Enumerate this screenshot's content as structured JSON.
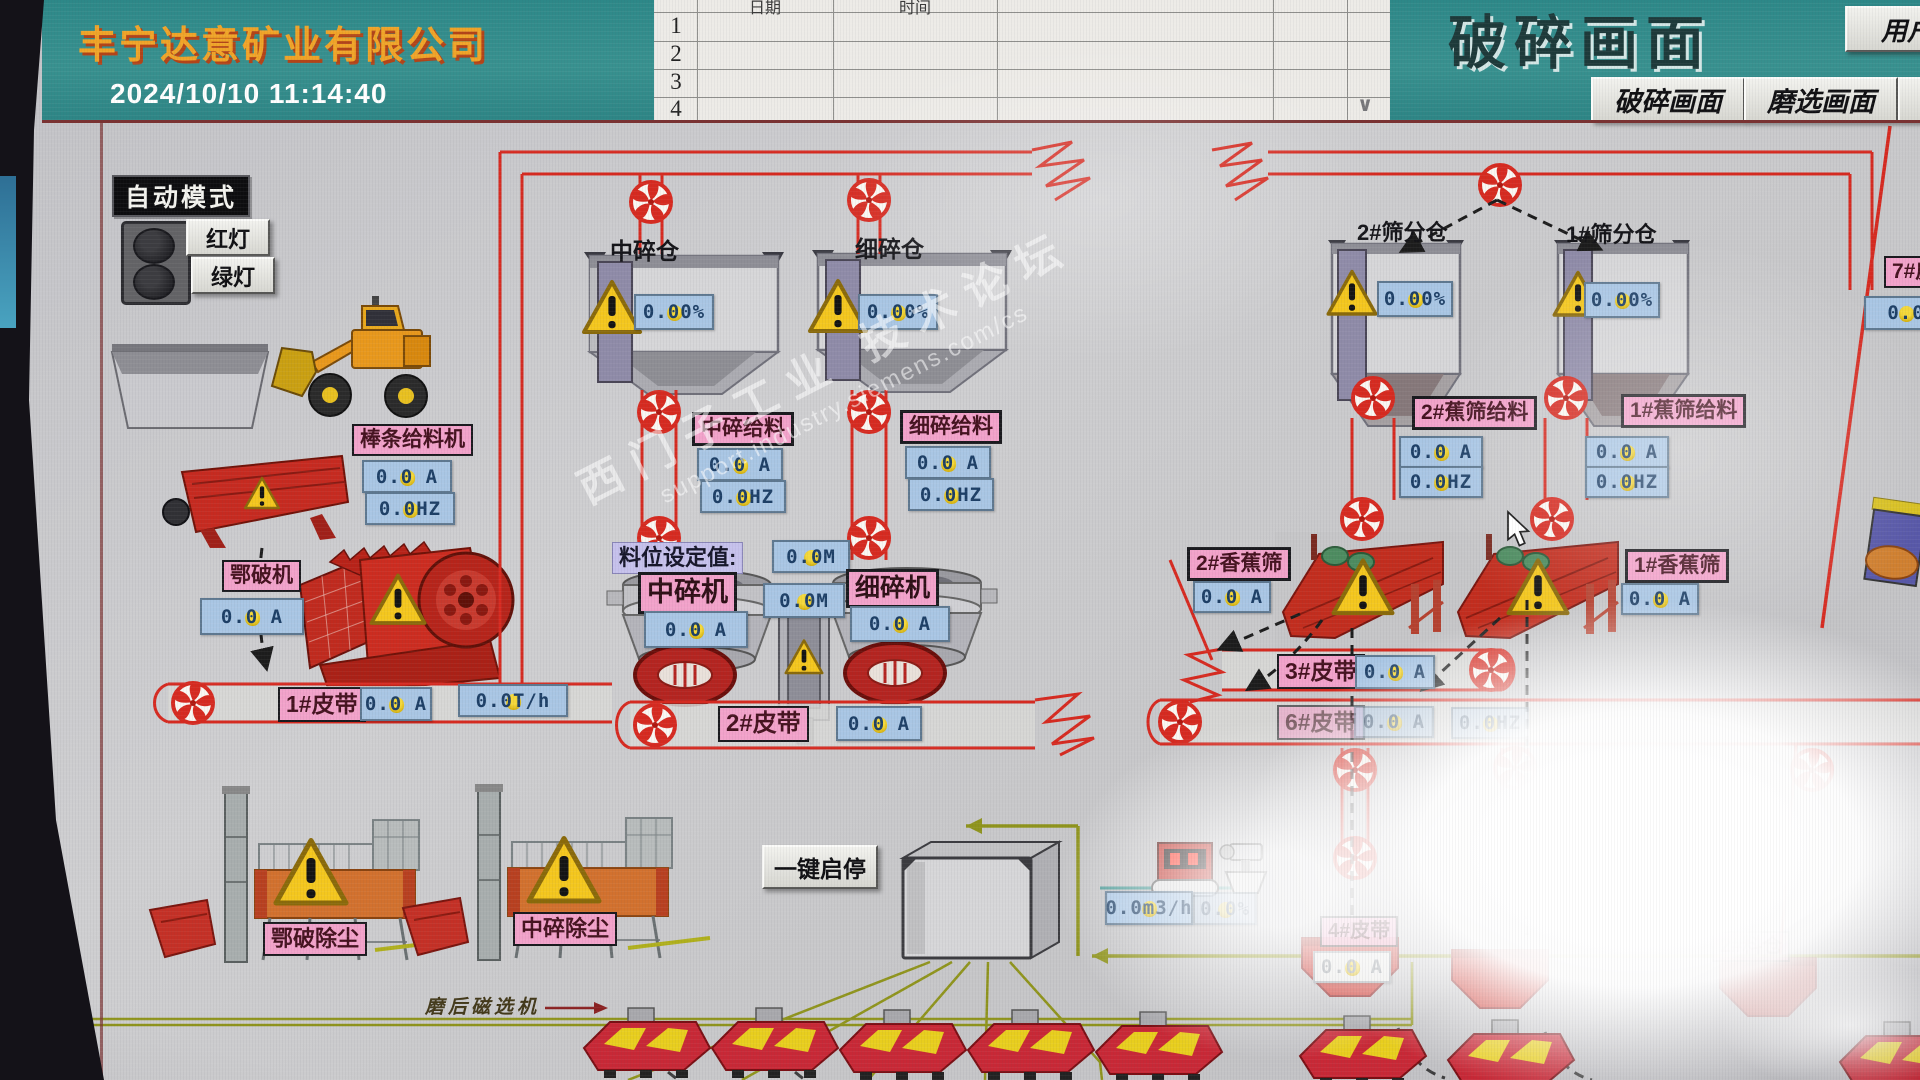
{
  "header": {
    "company_name": "丰宁达意矿业有限公司",
    "datetime": "2024/10/10 11:14:40",
    "screen_title": "破碎画面",
    "user_button": "用户",
    "tab_crushing": "破碎画面",
    "tab_grinding": "磨选画面",
    "log_table": {
      "col_date": "日期",
      "col_time": "时间",
      "row_numbers": [
        "1",
        "2",
        "3",
        "4"
      ],
      "scroll_hint": "∨"
    }
  },
  "status_panel": {
    "mode_label": "自动模式",
    "red_light_label": "红灯",
    "green_light_label": "绿灯"
  },
  "equipment": {
    "bar_feeder": {
      "label": "棒条给料机",
      "current": "0.0 A",
      "freq": "0.0HZ"
    },
    "jaw_crusher": {
      "label": "鄂破机",
      "current": "0.0 A"
    },
    "belt1": {
      "label": "1#皮带",
      "current": "0.0 A",
      "throughput": "0.0T/h"
    },
    "mid_bin": {
      "label": "中碎仓",
      "level_pct": "0.00%"
    },
    "fine_bin": {
      "label": "细碎仓",
      "level_pct": "0.00%"
    },
    "mid_feeder": {
      "label": "中碎给料",
      "current": "0.0 A",
      "freq": "0.0HZ"
    },
    "fine_feeder": {
      "label": "细碎给料",
      "current": "0.0 A",
      "freq": "0.0HZ"
    },
    "level_setpoint": {
      "label": "料位设定值:",
      "setpoint": "0.0M",
      "measured": "0.0M"
    },
    "mid_crusher": {
      "label": "中碎机",
      "current": "0.0 A"
    },
    "fine_crusher": {
      "label": "细碎机",
      "current": "0.0 A"
    },
    "belt2": {
      "label": "2#皮带",
      "current": "0.0 A"
    },
    "screen_bin2": {
      "label": "2#筛分仓",
      "level_pct": "0.00%"
    },
    "screen_bin1": {
      "label": "1#筛分仓",
      "level_pct": "0.00%"
    },
    "banana_feeder2": {
      "label": "2#蕉筛给料",
      "current": "0.0 A",
      "freq": "0.0HZ"
    },
    "banana_feeder1": {
      "label": "1#蕉筛给料",
      "current": "0.0 A",
      "freq": "0.0HZ"
    },
    "banana_screen2": {
      "label": "2#香蕉筛",
      "current": "0.0 A"
    },
    "banana_screen1": {
      "label": "1#香蕉筛",
      "current": "0.0 A"
    },
    "belt3": {
      "label": "3#皮带",
      "current": "0.0 A"
    },
    "belt6": {
      "label": "6#皮带",
      "current": "0.0 A",
      "freq": "0.0HZ"
    },
    "belt7": {
      "label": "7#皮带",
      "current": "0.0"
    },
    "belt4": {
      "label": "4#皮带",
      "current": "0.0 A"
    },
    "bin2_lower": {
      "label": "2#料仓"
    },
    "jaw_dust": {
      "label": "鄂破除尘"
    },
    "mid_dust": {
      "label": "中碎除尘"
    }
  },
  "footer": {
    "one_key_button": "一键启停",
    "magnetic_note": "磨后磁选机",
    "flow_rate": "0.0m3/h",
    "flow_pct": "0.0%"
  },
  "watermark": {
    "line1": "西门子工业  技术论坛",
    "line2": "support.industry.siemens.com/cs"
  }
}
